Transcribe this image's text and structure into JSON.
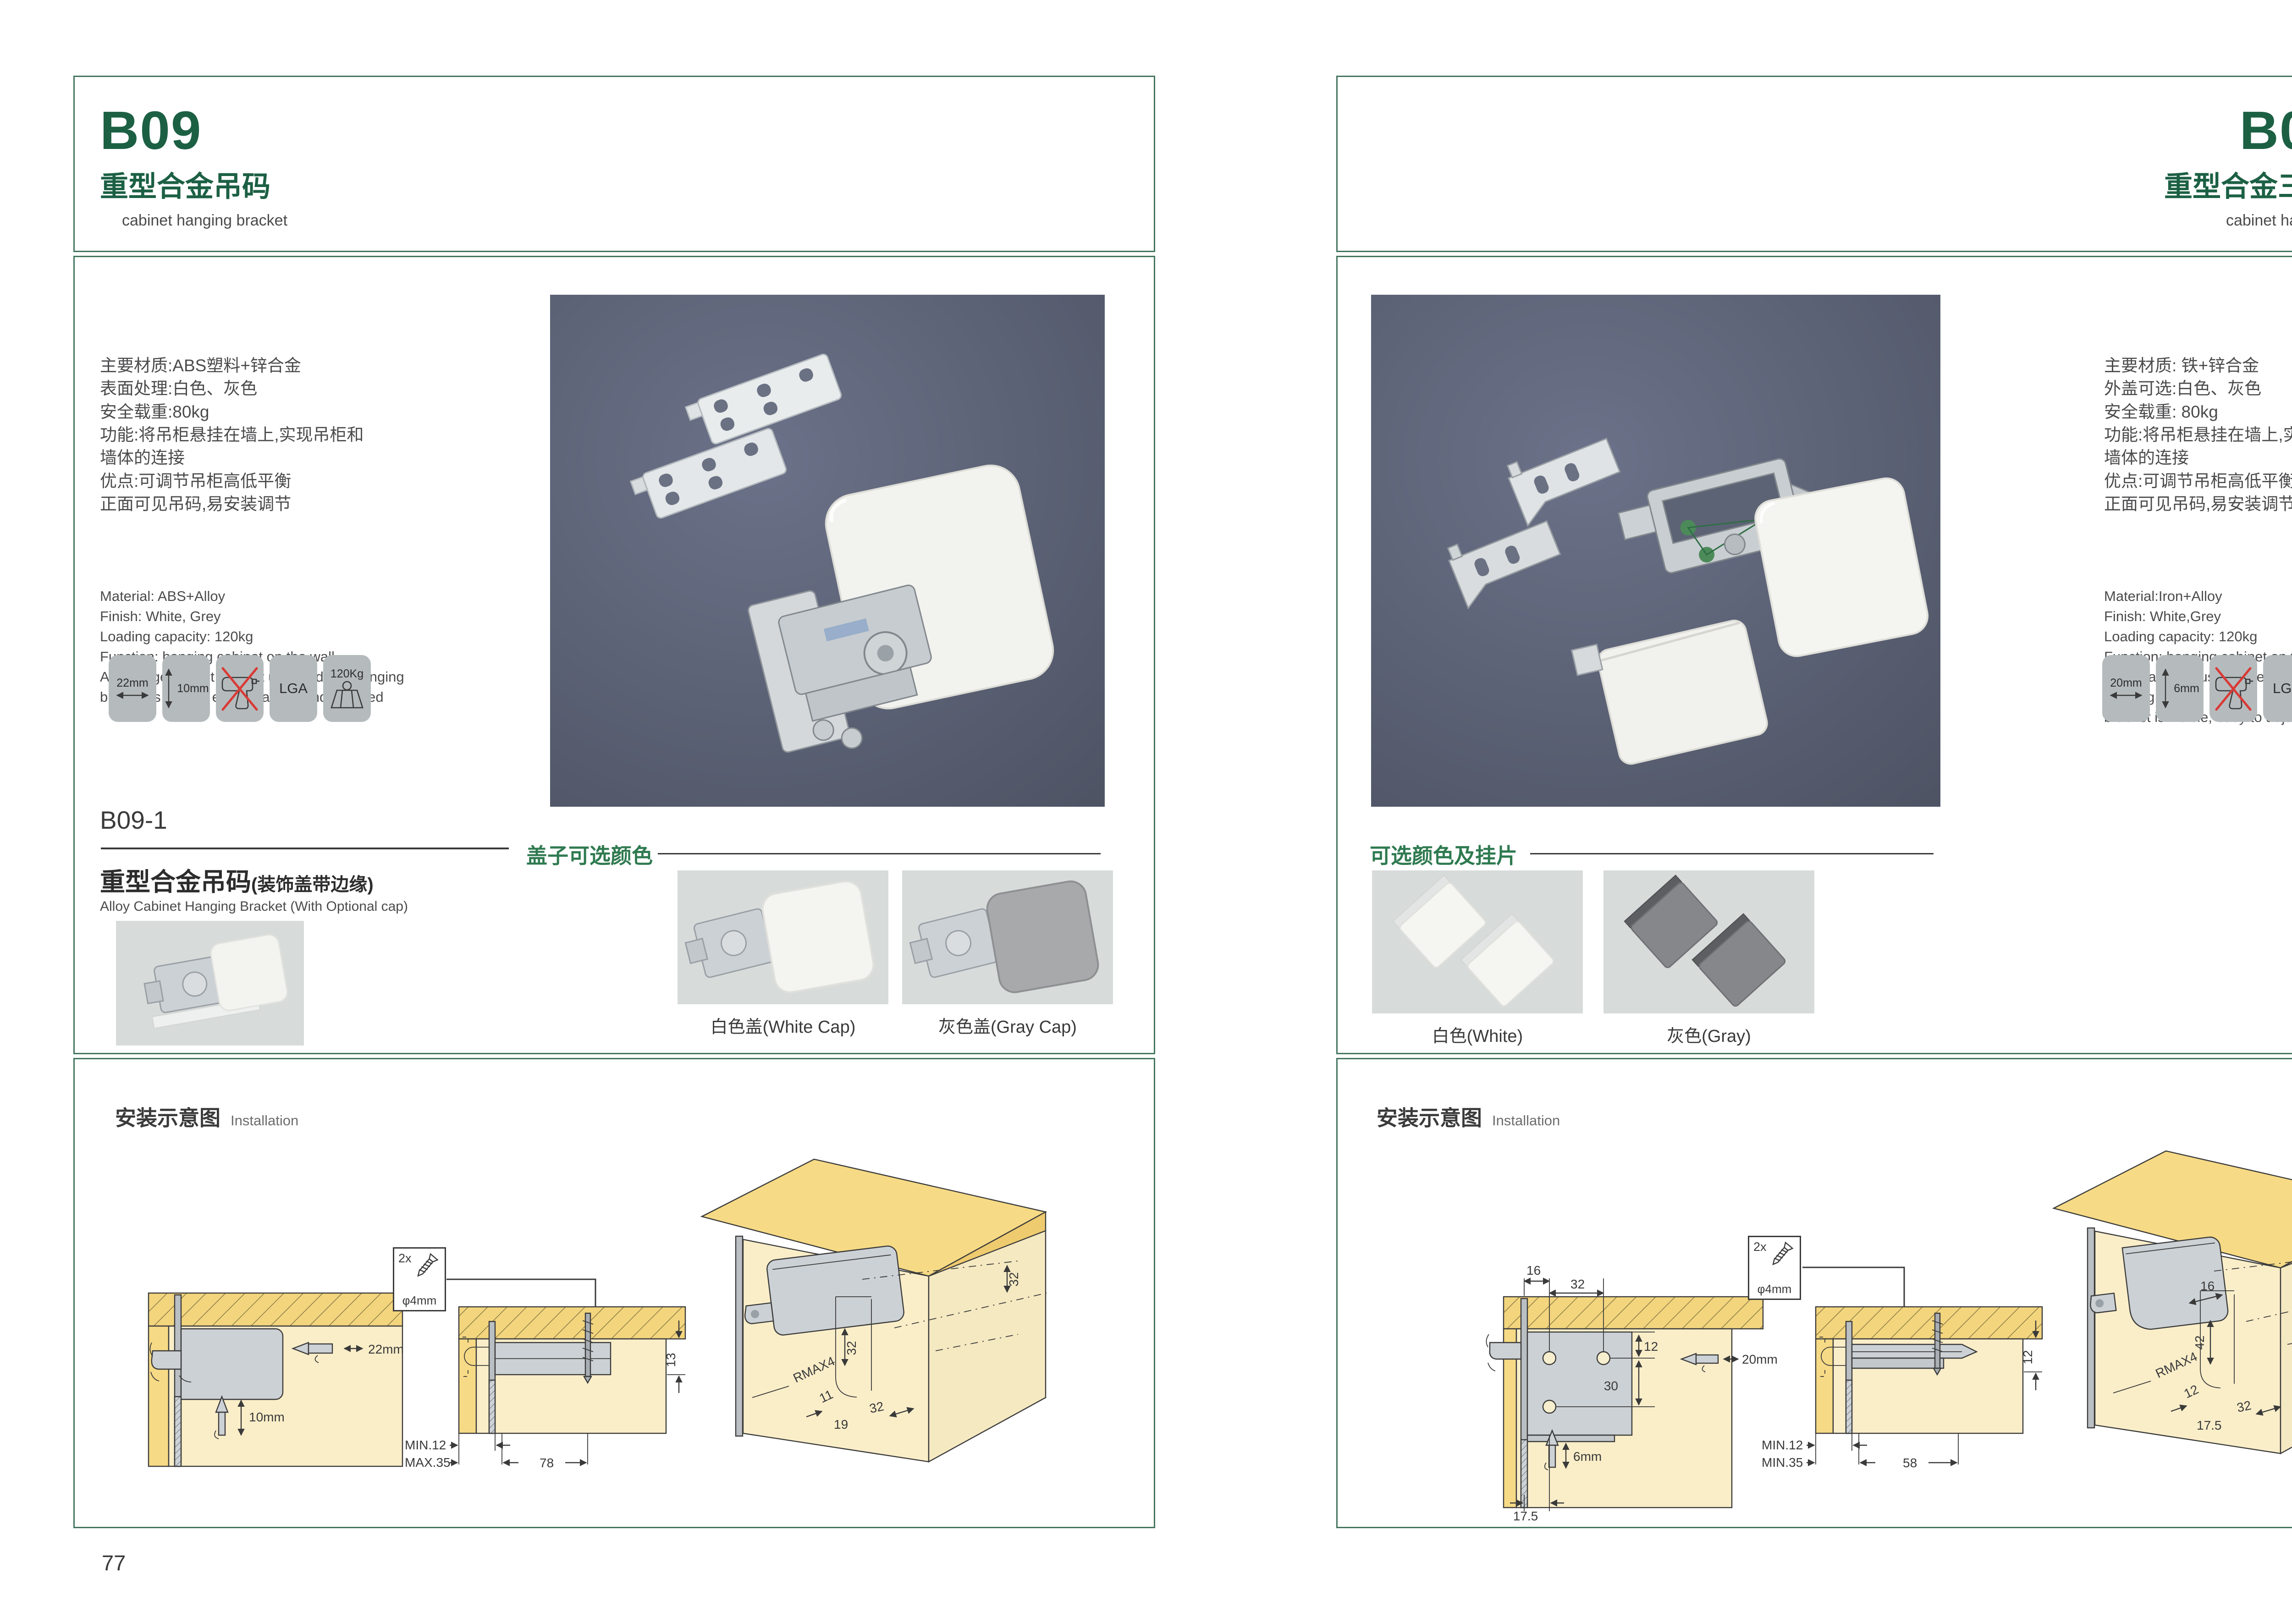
{
  "pages": [
    {
      "code": "B09",
      "title_cn": "重型合金吊码",
      "title_en": "cabinet hanging bracket",
      "specs_cn": [
        "主要材质:ABS塑料+锌合金",
        "表面处理:白色、灰色",
        "安全载重:80kg",
        "功能:将吊柜悬挂在墙上,实现吊柜和",
        "墙体的连接",
        "优点:可调节吊柜高低平衡",
        "正面可见吊码,易安装调节"
      ],
      "specs_en": [
        "Material: ABS+Alloy",
        "Finish: White, Grey",
        "Loading capacity: 120kg",
        "Function: hanging cabinet on the wall",
        "Advantage: Adjust cabinet up and down hanging",
        "bracket is visible, easy to adjust and installed"
      ],
      "badges": {
        "width": "22mm",
        "height": "10mm",
        "cert": "LGA",
        "load": "120Kg"
      },
      "sub": {
        "code": "B09-1",
        "cn": "重型合金吊码",
        "cn_paren": "(装饰盖带边缘)",
        "en": "Alloy Cabinet Hanging Bracket (With Optional cap)"
      },
      "options": {
        "heading": "盖子可选颜色",
        "cap1": "白色盖(White Cap)",
        "cap2": "灰色盖(Gray Cap)"
      },
      "install": {
        "cn": "安装示意图",
        "en": "Installation",
        "screw_qty": "2x",
        "screw_dia": "φ4mm",
        "dA": {
          "w": "22mm",
          "h": "10mm"
        },
        "dB": {
          "t": "13",
          "min": "MIN.12",
          "max": "MAX.35",
          "w": "78"
        },
        "dC": {
          "d32a": "32",
          "d32b": "32",
          "r": "RMAX4",
          "d11": "11",
          "d19": "19",
          "d32c": "32"
        }
      },
      "page_number": "77"
    },
    {
      "code": "B09-3",
      "title_cn": "重型合金三孔吊码",
      "title_en": "cabinet hanging bracket",
      "specs_cn": [
        "主要材质: 铁+锌合金",
        "外盖可选:白色、灰色",
        "安全载重: 80kg",
        "功能:将吊柜悬挂在墙上,实现吊柜和",
        "墙体的连接",
        "优点:可调节吊柜高低平衡",
        "正面可见吊码,易安装调节"
      ],
      "specs_en": [
        "Material:Iron+Alloy",
        "Finish: White,Grey",
        "Loading capacity: 120kg",
        "Function: hanging cabinet on the wall",
        "Advantage: Adjust cabinet up and down hanging",
        "bracket is visible, easy to adjust and installed"
      ],
      "badges": {
        "width": "20mm",
        "height": "6mm",
        "cert": "LGA",
        "load": "120Kg"
      },
      "options": {
        "heading": "可选颜色及挂片",
        "cap1": "白色(White)",
        "cap2": "灰色(Gray)"
      },
      "install": {
        "cn": "安装示意图",
        "en": "Installation",
        "screw_qty": "2x",
        "screw_dia": "φ4mm",
        "dA": {
          "t16": "16",
          "t32": "32",
          "d12": "12",
          "d30": "30",
          "w": "20mm",
          "h": "6mm",
          "b": "17.5"
        },
        "dB": {
          "t": "12",
          "min": "MIN.12",
          "min2": "MIN.35",
          "w": "58"
        },
        "dC": {
          "top12": "12",
          "d16": "16",
          "d42": "42",
          "r": "RMAX4",
          "d12": "12",
          "d175": "17.5",
          "d32": "32"
        }
      },
      "page_number": "78"
    }
  ]
}
